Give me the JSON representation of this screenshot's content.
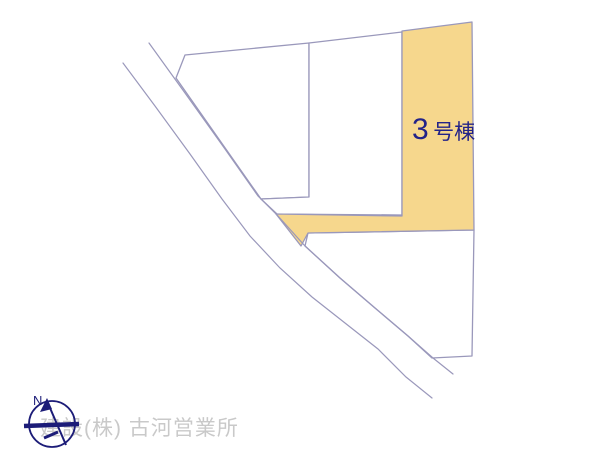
{
  "plan": {
    "background": "#ffffff",
    "line_color": "#9a98bb",
    "highlight": {
      "full_label": "3号棟",
      "label_number": "3",
      "label_suffix": "号棟",
      "fill": "#f6d78d",
      "label_color": "#232388"
    },
    "plots": [
      {
        "name": "upper-left",
        "fill": "#ffffff"
      },
      {
        "name": "upper-middle",
        "fill": "#ffffff"
      },
      {
        "name": "plot-3",
        "fill": "#f6d78d",
        "label": "3号棟"
      },
      {
        "name": "lower-right",
        "fill": "#ffffff"
      }
    ]
  },
  "compass": {
    "label": "N",
    "color": "#1c1c78"
  },
  "watermark": {
    "text": "建設(株) 古河営業所",
    "color": "#c9c9c9"
  }
}
